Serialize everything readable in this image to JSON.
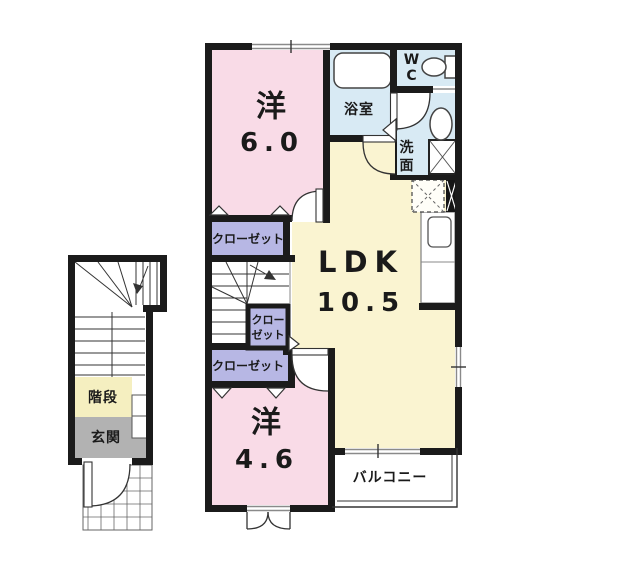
{
  "title": "2F apartment floor plan",
  "colors": {
    "wall": "#1b1b1b",
    "room_pink": "#f9dbe7",
    "closet_purple": "#b7b7e4",
    "wet_blue": "#d8eaf4",
    "ldk_yellow": "#faf4d1",
    "stair_yellow": "#f5efc0",
    "genkan_gray": "#b2b2b2",
    "text": "#1a1a1a"
  },
  "rooms": {
    "bedroom1": {
      "name": "洋",
      "size": "6.0"
    },
    "bedroom2": {
      "name": "洋",
      "size": "4.6"
    },
    "ldk": {
      "name": "LDK",
      "size": "10.5"
    },
    "bath": {
      "label": "浴室"
    },
    "wc": {
      "line1": "W",
      "line2": "C"
    },
    "washroom": {
      "line1": "洗",
      "line2": "面"
    },
    "closet_upper": {
      "label": "クローゼット"
    },
    "closet_small": {
      "line1": "クロー",
      "line2": "ゼット"
    },
    "closet_lower": {
      "label": "クローゼット"
    },
    "balcony": {
      "label": "バルコニー"
    },
    "staircase": {
      "label": "階段"
    },
    "entrance": {
      "label": "玄関"
    }
  }
}
